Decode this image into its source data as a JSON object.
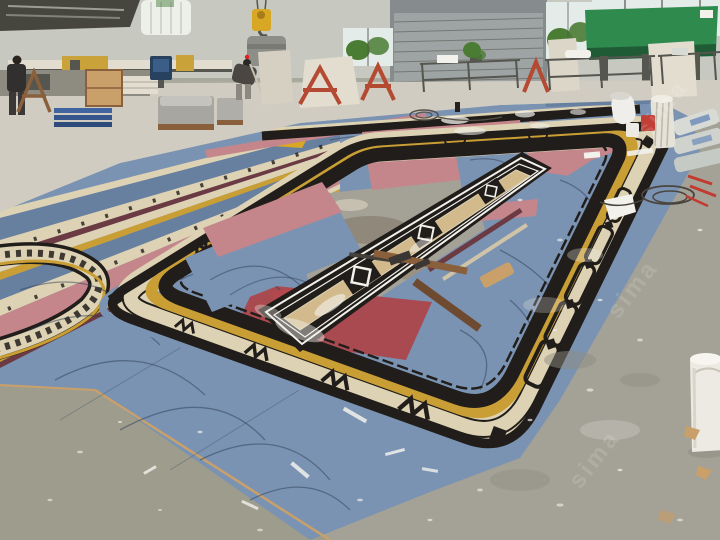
{
  "meta": {
    "type": "photograph"
  },
  "scene": {
    "description": "Marble inlay workshop: large decorative stone floor medallion with cream, black, gold border bands on blue and pink backing panels, laid out on a factory floor with machinery, work tables, roller door and workers in the background",
    "watermark": "sima",
    "objects": [
      "warehouse-wall",
      "skylight-roof-structure",
      "water-storage-tank",
      "crane-hoist",
      "stone-cutting-machine",
      "machine-monitor",
      "worker-standing",
      "worker-bending",
      "wooden-crate",
      "blue-pallet-stack",
      "shrink-wrapped-pallet",
      "leaning-marble-slabs",
      "red-a-frame-rack",
      "roller-shutter-door",
      "window-with-trees",
      "clerestory-windows",
      "green-machine-panel",
      "steel-work-tables",
      "potted-plant",
      "marble-medallion-border-ring",
      "greek-key-corner-band",
      "left-medallion-strips",
      "central-runner-inlay",
      "blue-backing-panels",
      "pink-backing-panels",
      "red-marble-panels",
      "wooden-battens",
      "cement-bag-stack",
      "white-column-piece",
      "paper-roll",
      "paint-buckets",
      "wire-coil",
      "red-marker-sticks",
      "large-white-bucket",
      "stone-chips",
      "floor-debris"
    ]
  },
  "palette": {
    "wall": "#c7c9c0",
    "wall_dark": "#a9a99e",
    "roof_dark": "#46463e",
    "window": "#e4ecea",
    "tree": "#4a7c33",
    "door": "#9ea3a3",
    "door_dark": "#868c8e",
    "machine_green": "#2f8a4e",
    "machine_green_dark": "#1f5c36",
    "steel": "#55564f",
    "slab": "#e3ddd0",
    "frame_red": "#b34a31",
    "hoist": "#d8a824",
    "tank": "#edefe9",
    "floor": "#b9b4a8",
    "floor_light": "#d0ccc1",
    "floor_dark": "#a4a196",
    "floor_green": "#9d9c8d",
    "panel_blue": "#7b93b2",
    "panel_blue_dark": "#68809f",
    "scribble": "#2d3e57",
    "panel_pink": "#c4868b",
    "panel_red": "#a84a50",
    "red_bright": "#b5474e",
    "cream": "#ded2b4",
    "tan": "#d2ba8c",
    "gold": "#c99f35",
    "marble_black": "#211d1a",
    "maroon": "#6b3a42",
    "wood": "#8a5f3c",
    "wood_light": "#c9a06a",
    "bucket": "#eceae2",
    "white": "#f2f1ec",
    "bag": "#d7dad5"
  }
}
